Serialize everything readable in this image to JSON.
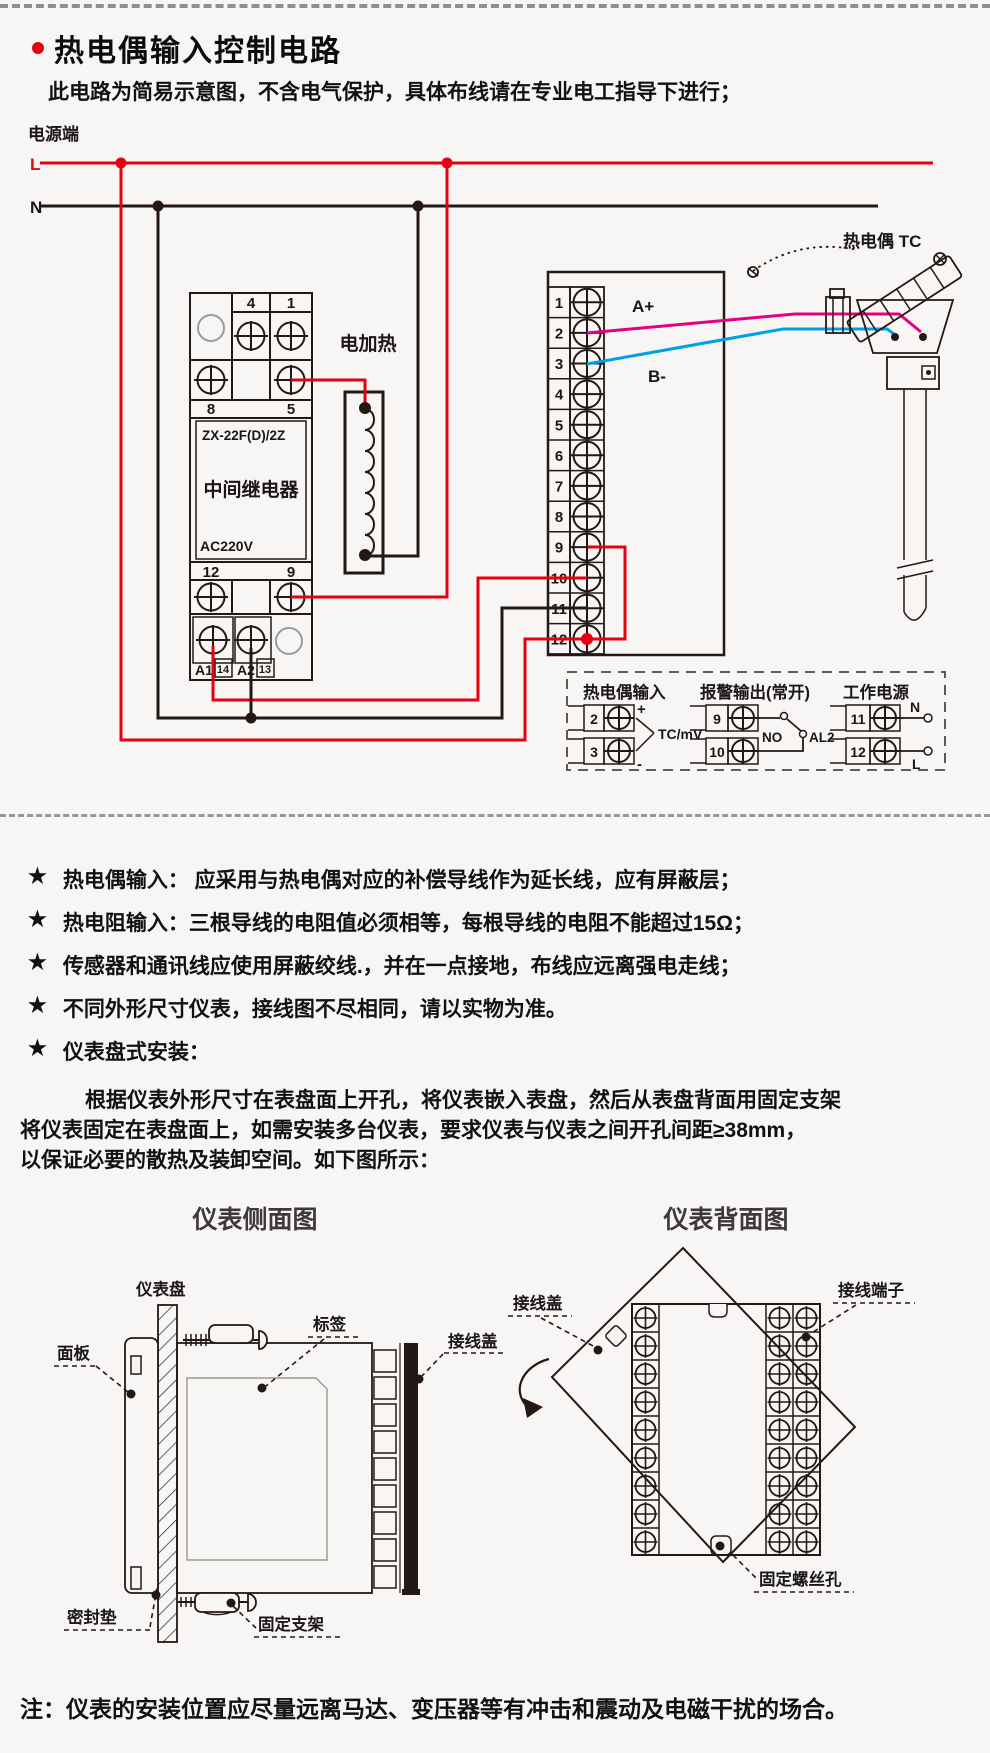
{
  "header": {
    "title": "热电偶输入控制电路",
    "subtitle": "此电路为简易示意图，不含电气保护，具体布线请在专业电工指导下进行；",
    "accent_color": "#e60012"
  },
  "circuit": {
    "power_label": "电源端",
    "line_l": "L",
    "line_n": "N",
    "relay": {
      "top_terminals": [
        "4",
        "1"
      ],
      "mid_terminals": [
        "8",
        "5"
      ],
      "model": "ZX-22F(D)/2Z",
      "name": "中间继电器",
      "voltage": "AC220V",
      "low_terminals": [
        "12",
        "9"
      ],
      "bottom_terminals": [
        "A1",
        "14",
        "A2",
        "13"
      ]
    },
    "heater_label": "电加热",
    "terminal_numbers": [
      "1",
      "2",
      "3",
      "4",
      "5",
      "6",
      "7",
      "8",
      "9",
      "10",
      "11",
      "12"
    ],
    "wire_a_label": "A+",
    "wire_b_label": "B-",
    "tc_label": "热电偶 TC",
    "colors": {
      "live": "#e60012",
      "neutral": "#231815",
      "wire_a": "#e4007f",
      "wire_b": "#00a0e9"
    }
  },
  "legend": {
    "group1": {
      "title": "热电偶输入",
      "terminals": [
        "2",
        "3"
      ],
      "plus": "+",
      "minus": "-",
      "signal": "TC/mV"
    },
    "group2": {
      "title": "报警输出(常开)",
      "terminals": [
        "9",
        "10"
      ],
      "no_label": "NO",
      "al_label": "AL2"
    },
    "group3": {
      "title": "工作电源",
      "terminals": [
        "11",
        "12"
      ],
      "n_label": "N",
      "l_label": "L"
    }
  },
  "notes": {
    "star": "★",
    "bullets": [
      "热电偶输入： 应采用与热电偶对应的补偿导线作为延长线，应有屏蔽层；",
      "热电阻输入：三根导线的电阻值必须相等，每根导线的电阻不能超过15Ω；",
      "传感器和通讯线应使用屏蔽绞线.，并在一点接地，布线应远离强电走线；",
      "不同外形尺寸仪表，接线图不尽相同，请以实物为准。",
      "仪表盘式安装："
    ],
    "paragraph_lines": [
      "根据仪表外形尺寸在表盘面上开孔，将仪表嵌入表盘，然后从表盘背面用固定支架",
      "将仪表固定在表盘面上，如需安装多台仪表，要求仪表与仪表之间开孔间距≥38mm，",
      "以保证必要的散热及装卸空间。如下图所示："
    ],
    "footnote": "注：仪表的安装位置应尽量远离马达、变压器等有冲击和震动及电磁干扰的场合。"
  },
  "side_view": {
    "title": "仪表侧面图",
    "labels": {
      "panel": "仪表盘",
      "front": "面板",
      "tag": "标签",
      "cover": "接线盖",
      "gasket": "密封垫",
      "bracket": "固定支架"
    }
  },
  "back_view": {
    "title": "仪表背面图",
    "labels": {
      "cover": "接线盖",
      "terminal": "接线端子",
      "screw_hole": "固定螺丝孔"
    }
  }
}
